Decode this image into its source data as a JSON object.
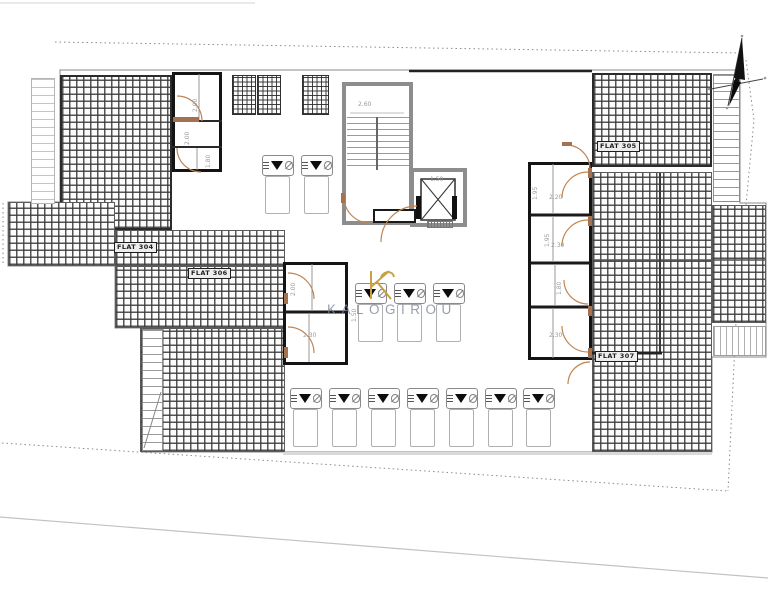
{
  "watermark": {
    "logo_letter": "K",
    "brand": "KALOGIROU"
  },
  "flat_labels": {
    "top_left": "FLAT 304",
    "center_left": "FLAT 306",
    "top_right": "FLAT 305",
    "bottom_right": "FLAT 307"
  },
  "dimensions": {
    "stair_width": "2.60",
    "top_room_upper": "2.00",
    "top_room_lower": "2.00",
    "top_room_lower_b": "1.80",
    "lift": "1.50",
    "corridor": "1.50",
    "left_room_upper": "2.00",
    "left_room_lower": "2.30",
    "right_room_1_w": "2.20",
    "right_room_1_h": "1.95",
    "right_room_2_w": "2.30",
    "right_room_2_h": "1.95",
    "right_room_3_h": "1.80",
    "right_room_4_w": "2.30"
  },
  "colors": {
    "hatch_line": "#3c3c3c",
    "wall": "#141414",
    "core_wall": "#8d8d8d",
    "door_arc": "#c08552",
    "threshold": "#a4724f",
    "watermark_text": "#7d879b",
    "watermark_logo": "#c7a144",
    "boundary": "#8a8a8a"
  }
}
